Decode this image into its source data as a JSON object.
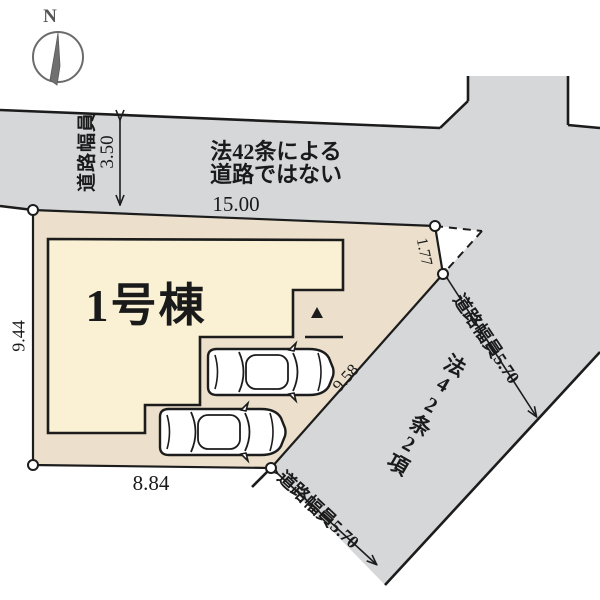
{
  "compass": {
    "north_label": "N"
  },
  "colors": {
    "road": "#d5d7d9",
    "lot": "#ece0cc",
    "building": "#faf1d4",
    "line": "#1c1c1c"
  },
  "roads": {
    "top_note_line1": "法42条による",
    "top_note_line2": "道路ではない",
    "top_width_label": "道路幅員",
    "top_width_value": "3.50",
    "right_width_label": "道路幅員5.70",
    "right_article_label": "法42条2項",
    "bottom_width_label": "道路幅員5.70"
  },
  "lot": {
    "dim_top": "15.00",
    "dim_left": "9.44",
    "dim_bottom": "8.84",
    "dim_corner": "1.77",
    "dim_diagonal": "9.58"
  },
  "building": {
    "label": "1号棟"
  }
}
